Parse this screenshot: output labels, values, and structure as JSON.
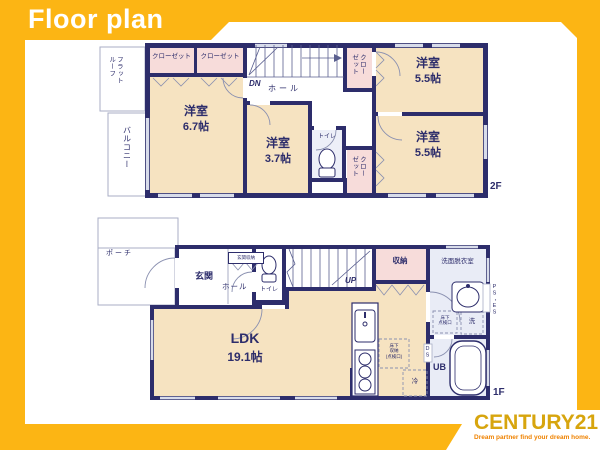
{
  "title": "Floor plan",
  "brand": {
    "name": "CENTURY21",
    "tagline": "Dream partner find your dream home."
  },
  "colors": {
    "background_gold": "#FCB514",
    "wall_navy": "#2D2D6B",
    "room_cream": "#F6E3C1",
    "closet_pink": "#F7DCDA",
    "wet_room": "#E9ECF6",
    "brand_gold": "#D7A50E",
    "brand_orange": "#EF8200"
  },
  "floor2": {
    "name": "2F",
    "closet1": "クローゼット",
    "closet2": "クローゼット",
    "flat_roof": "フラットルーフ",
    "balcony": "バルコニー",
    "room1": "洋室",
    "room1_size": "6.7帖",
    "room2": "洋室",
    "room2_size": "3.7帖",
    "hall": "ホール",
    "dn": "DN",
    "toilet": "トイレ",
    "closet3": "クローゼット",
    "closet4": "クローゼット",
    "room3": "洋室",
    "room3_size": "5.5帖",
    "room4": "洋室",
    "room4_size": "5.5帖"
  },
  "floor1": {
    "name": "1F",
    "porch": "ポーチ",
    "entrance": "玄関",
    "hall": "ホール",
    "entrance_storage": "玄関収納",
    "toilet": "トイレ",
    "up": "UP",
    "storage": "収納",
    "washroom": "洗面脱衣室",
    "ldk": "LDK",
    "ldk_size": "19.1帖",
    "floor_storage": "床下\n収納\n(点検口)",
    "fridge": "冷",
    "floor_hatch": "床下\n点検口",
    "washer": "洗",
    "unit_bath": "UB",
    "ds": "DS",
    "ps_es": "PS・ES"
  }
}
